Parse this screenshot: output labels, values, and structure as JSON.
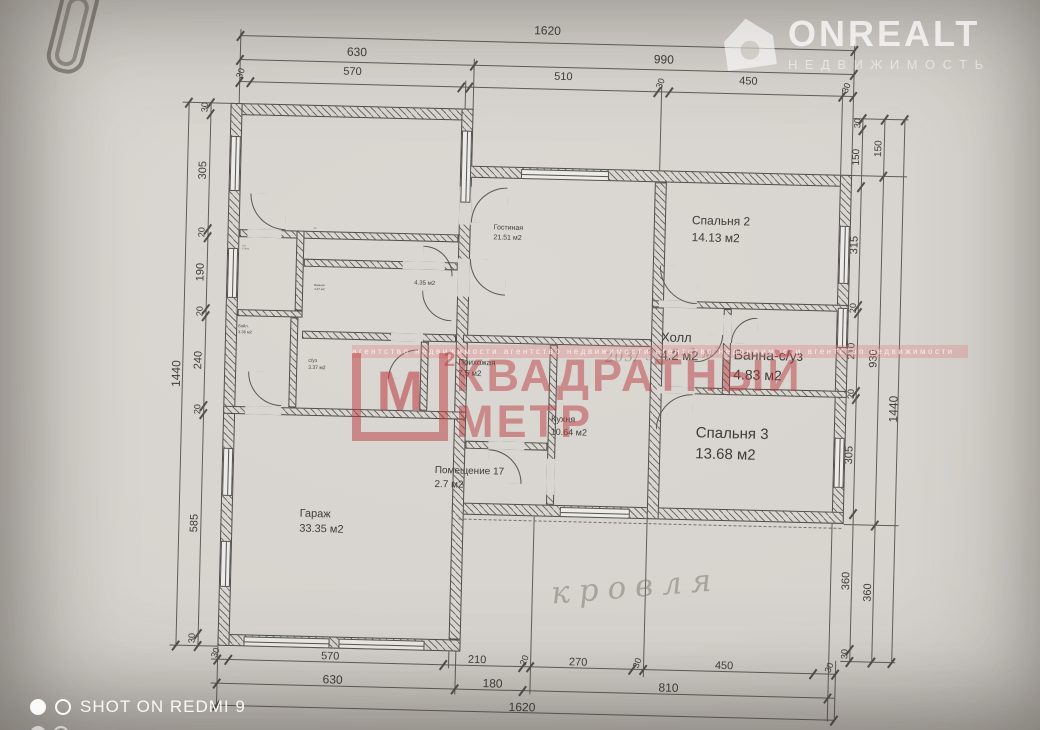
{
  "colors": {
    "watermark_red": "#bb393d",
    "paper": "#d9d5d0"
  },
  "rooms": [
    {
      "name": "Спальня 1",
      "area": "17.16 м2"
    },
    {
      "name": "шкаф",
      "area": "2.02 м2"
    },
    {
      "name": "с/уз",
      "area": "2.76 м2"
    },
    {
      "name": "Ванная",
      "area": "4.27 м2"
    },
    {
      "name": "Бойл.",
      "area": "3.36 м2"
    },
    {
      "name": "с/уз",
      "area": "3.37 м2"
    },
    {
      "name": "",
      "area": "4.35 м2"
    },
    {
      "name": "Гостиная",
      "area": "21.51 м2"
    },
    {
      "name": "Прихожая",
      "area": "7.5 м2"
    },
    {
      "name": "Кухня",
      "area": "10.64 м2"
    },
    {
      "name": "Помещение 17",
      "area": "2.7 м2"
    },
    {
      "name": "Гараж",
      "area": "33.35 м2"
    },
    {
      "name": "Спальня 2",
      "area": "14.13 м2"
    },
    {
      "name": "Холл",
      "area": "4.2 м2"
    },
    {
      "name": "Ванна-с/уз",
      "area": "4.83 м2"
    },
    {
      "name": "Спальня 3",
      "area": "13.68 м2"
    }
  ],
  "dims": {
    "top": {
      "total": "1620",
      "row2": [
        "630",
        "990"
      ],
      "row3": [
        "30",
        "570",
        "510",
        "30",
        "450",
        "30"
      ]
    },
    "bottom": {
      "row1": [
        "30",
        "570",
        "210",
        "20",
        "270",
        "30",
        "450",
        "30"
      ],
      "row2": [
        "630",
        "180",
        "810"
      ],
      "total": "1620"
    },
    "left": {
      "total": "1440",
      "col": [
        "30",
        "305",
        "20",
        "190",
        "20",
        "240",
        "20",
        "585",
        "30"
      ]
    },
    "right": {
      "col1": [
        "30",
        "150",
        "315",
        "20",
        "210",
        "20",
        "305",
        "360",
        "30"
      ],
      "col2": [
        "150",
        "930",
        "360"
      ],
      "total": "1440"
    }
  },
  "handwriting": {
    "roof_label": "кровля",
    "area_note": "203/ 35,5-6 м²"
  },
  "watermarks": {
    "agency": {
      "logo_letter": "М",
      "logo_sup": "2",
      "line1": "КВАДРАТНЫЙ",
      "line2": "МЕТР",
      "strip": "агентство недвижимости   агентство недвижимости   агентство недвижимости   агентство недвижимости"
    },
    "onrealt": {
      "title": "ONREALT",
      "subtitle": "НЕДВИЖИМОСТЬ"
    },
    "camera": {
      "label": "SHOT ON REDMI 9"
    }
  }
}
